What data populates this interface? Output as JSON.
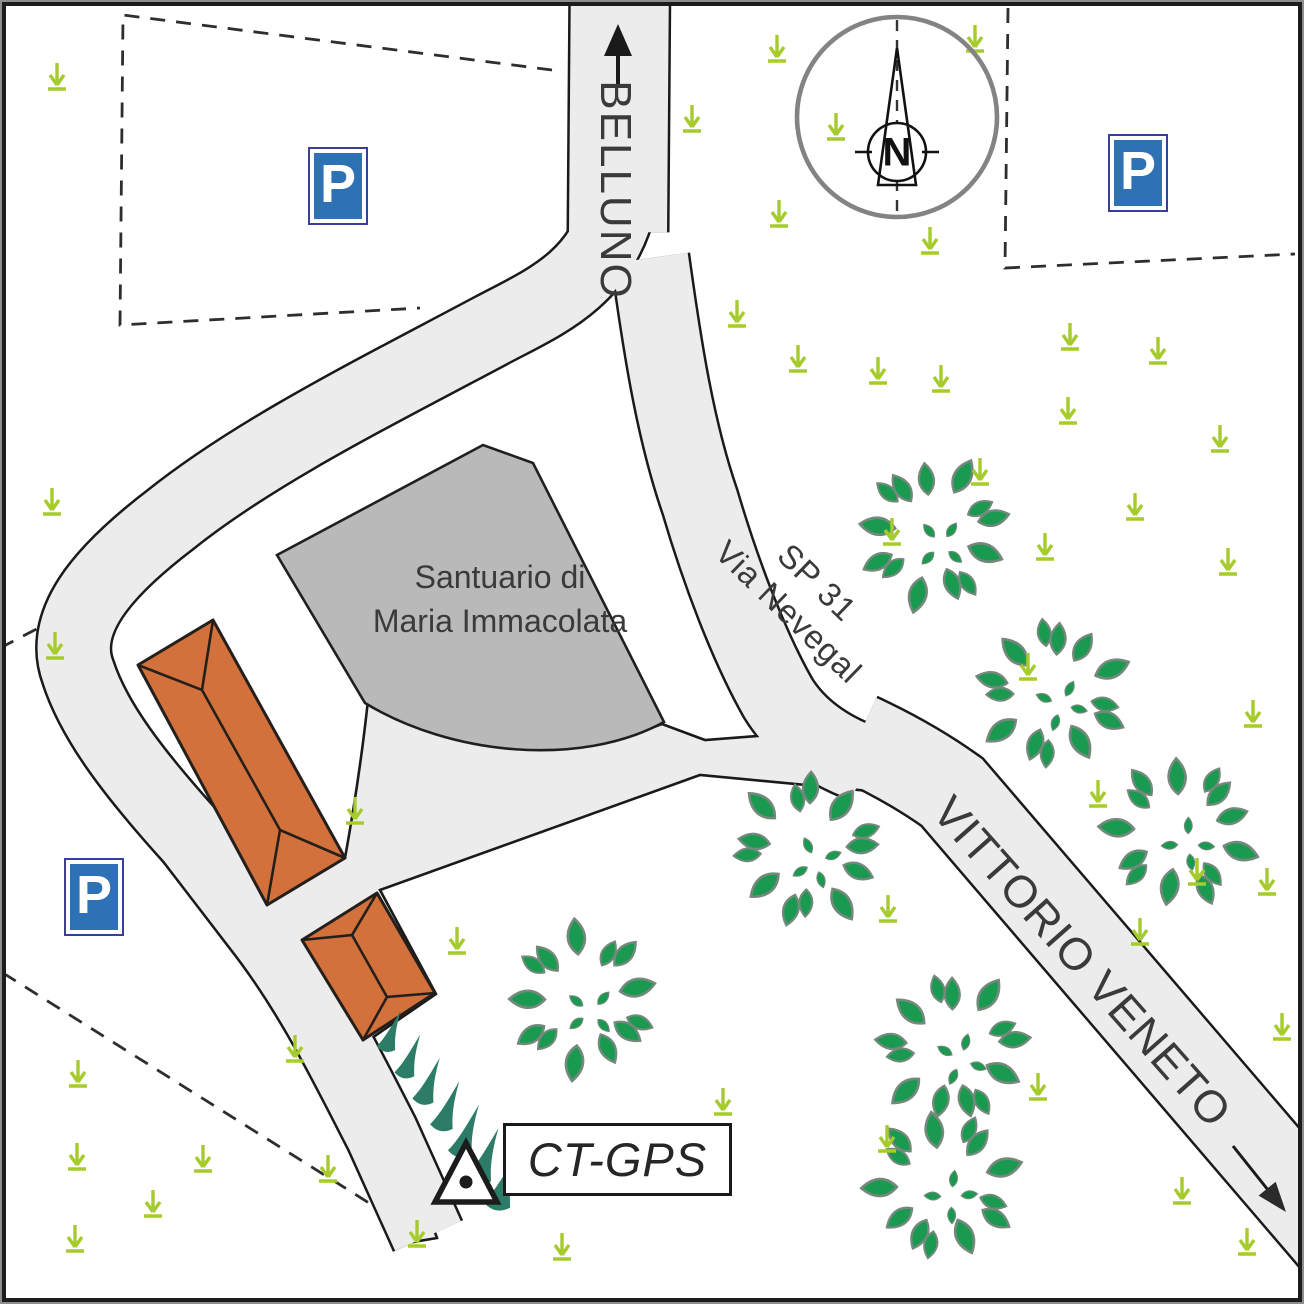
{
  "labels": {
    "road_north": "BELLUNO",
    "road_sp31_line1": "SP 31",
    "road_sp31_line2": "Via Nevegal",
    "road_southeast": "VITTORIO VENETO",
    "building_line1": "Santuario di",
    "building_line2": "Maria Immacolata",
    "gps_marker": "CT-GPS",
    "compass_north": "N",
    "parking_letter": "P"
  },
  "colors": {
    "road_fill": "#ececec",
    "road_casing": "#1a1a1a",
    "building_fill": "#b9b9b9",
    "building_stroke": "#1f1f1f",
    "house_fill": "#d2713c",
    "house_stroke": "#241f1a",
    "tree_leaf": "#1a9a50",
    "tree_outline": "#74897c",
    "grass": "#a6cb2d",
    "hedge": "#2d7c67",
    "parking_blue": "#2e72b5",
    "text": "#3a3a3a",
    "dash": "#2e2e2e",
    "compass_ring": "#838383"
  },
  "map_features": {
    "trees": [
      [
        933,
        533,
        0
      ],
      [
        1053,
        693,
        40
      ],
      [
        1180,
        832,
        80
      ],
      [
        808,
        850,
        120
      ],
      [
        583,
        1000,
        160
      ],
      [
        953,
        1048,
        200
      ],
      [
        943,
        1185,
        240
      ]
    ],
    "grass_tufts": [
      [
        57,
        78
      ],
      [
        777,
        50
      ],
      [
        975,
        40
      ],
      [
        692,
        120
      ],
      [
        836,
        128
      ],
      [
        779,
        215
      ],
      [
        930,
        242
      ],
      [
        737,
        315
      ],
      [
        798,
        360
      ],
      [
        878,
        372
      ],
      [
        941,
        380
      ],
      [
        1070,
        338
      ],
      [
        1158,
        352
      ],
      [
        1068,
        412
      ],
      [
        1220,
        440
      ],
      [
        1135,
        508
      ],
      [
        980,
        473
      ],
      [
        892,
        533
      ],
      [
        1045,
        548
      ],
      [
        1228,
        563
      ],
      [
        1253,
        715
      ],
      [
        1028,
        668
      ],
      [
        1098,
        795
      ],
      [
        1197,
        873
      ],
      [
        1267,
        883
      ],
      [
        888,
        910
      ],
      [
        1140,
        933
      ],
      [
        1282,
        1028
      ],
      [
        1038,
        1088
      ],
      [
        887,
        1140
      ],
      [
        1182,
        1192
      ],
      [
        723,
        1103
      ],
      [
        562,
        1248
      ],
      [
        1247,
        1243
      ],
      [
        52,
        503
      ],
      [
        55,
        647
      ],
      [
        355,
        812
      ],
      [
        457,
        942
      ],
      [
        295,
        1050
      ],
      [
        78,
        1075
      ],
      [
        77,
        1158
      ],
      [
        203,
        1160
      ],
      [
        153,
        1205
      ],
      [
        75,
        1240
      ],
      [
        328,
        1170
      ],
      [
        417,
        1235
      ]
    ],
    "hedge_row": {
      "from": [
        386,
        1046
      ],
      "to": [
        497,
        1202
      ],
      "count": 7
    },
    "dashed_boundaries": [
      {
        "name": "parking-area-northwest",
        "points": [
          [
            552,
            70
          ],
          [
            123,
            15
          ],
          [
            120,
            325
          ],
          [
            420,
            308
          ]
        ]
      },
      {
        "name": "parking-area-northeast",
        "points": [
          [
            1008,
            8
          ],
          [
            1005,
            268
          ],
          [
            1295,
            254
          ]
        ]
      },
      {
        "name": "property-line-southwest",
        "points": [
          [
            3,
            973
          ],
          [
            412,
            1230
          ]
        ]
      },
      {
        "name": "property-line-west",
        "points": [
          [
            0,
            648
          ],
          [
            50,
            622
          ]
        ]
      }
    ],
    "gps_marker_point": [
      466,
      1182
    ]
  }
}
